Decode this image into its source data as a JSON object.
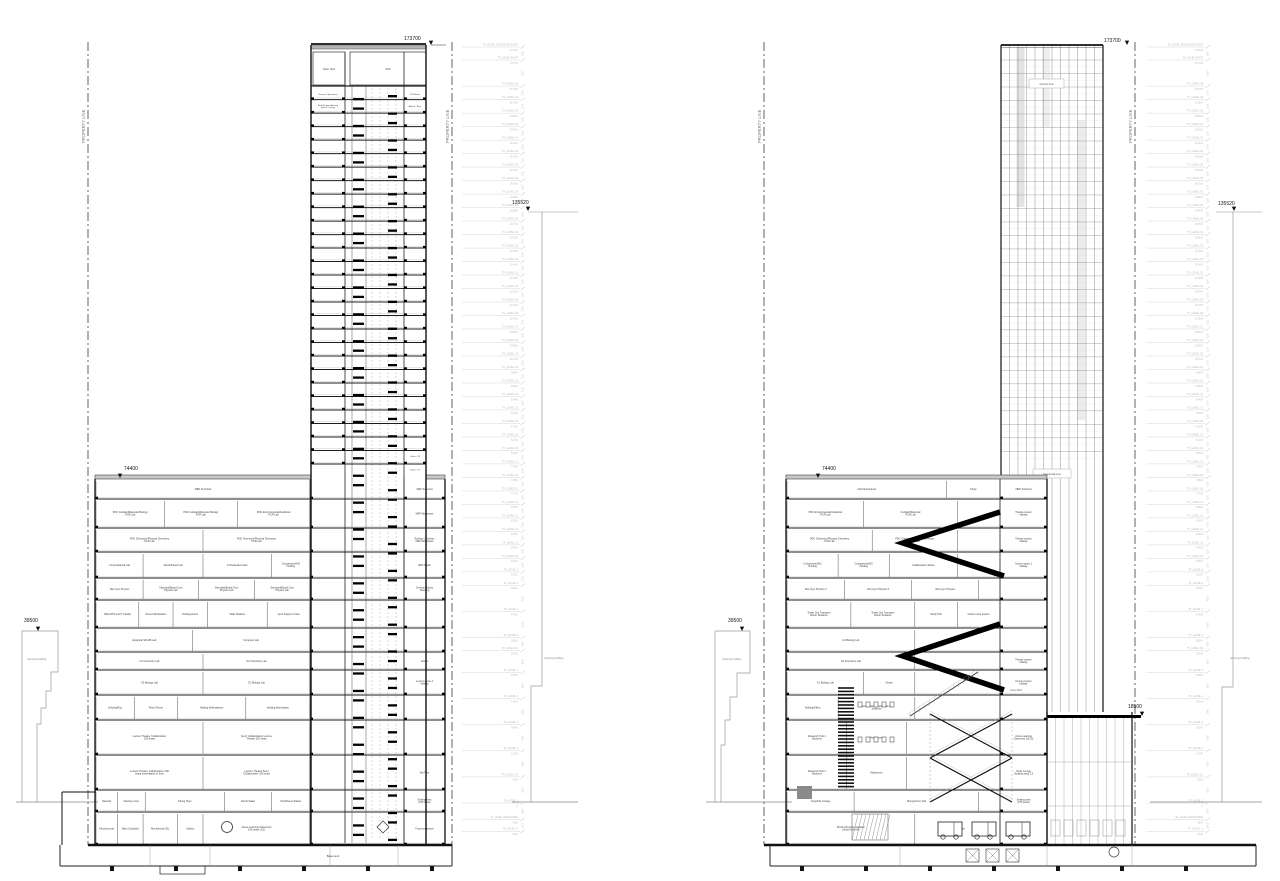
{
  "annotations": {
    "property_line": "PROPERTY LINE",
    "existing_building": "Existing building",
    "basement": "Basement"
  },
  "markers": {
    "tower_top": "173700",
    "mid_tower": "135520",
    "podium_top": "74400",
    "existing_left": "39500",
    "annex_roof": "18500"
  },
  "levels": [
    [
      "TF_LEVEL TECHNICAL ROOF",
      "173700",
      173700
    ],
    [
      "TF_LEVEL ROOF",
      "170700",
      170700
    ],
    [
      "TF_LEVEL 45",
      "164700",
      164700
    ],
    [
      "TF_LEVEL 44",
      "161600",
      161600
    ],
    [
      "TF_LEVEL 43",
      "158500",
      158500
    ],
    [
      "TF_LEVEL 42",
      "155400",
      155400
    ],
    [
      "TF_LEVEL 41",
      "152300",
      152300
    ],
    [
      "TF_LEVEL 40",
      "149200",
      149200
    ],
    [
      "TF_LEVEL 39",
      "146100",
      146100
    ],
    [
      "TF_LEVEL 38",
      "143000",
      143000
    ],
    [
      "TF_LEVEL 37",
      "139900",
      139900
    ],
    [
      "TF_LEVEL 36",
      "136800",
      136800
    ],
    [
      "TF_LEVEL 35",
      "133700",
      133700
    ],
    [
      "TF_LEVEL 34",
      "130600",
      130600
    ],
    [
      "TF_LEVEL 33",
      "127500",
      127500
    ],
    [
      "TF_LEVEL 32",
      "124400",
      124400
    ],
    [
      "TF_LEVEL 31",
      "121300",
      121300
    ],
    [
      "TF_LEVEL 30",
      "118200",
      118200
    ],
    [
      "TF_LEVEL 29",
      "115100",
      115100
    ],
    [
      "TF_LEVEL 28",
      "112000",
      112000
    ],
    [
      "TF_LEVEL 27",
      "108900",
      108900
    ],
    [
      "TF_LEVEL 26",
      "105800",
      105800
    ],
    [
      "TF_LEVEL 25",
      "102700",
      102700
    ],
    [
      "TF_LEVEL 24",
      "99600",
      99600
    ],
    [
      "TF_LEVEL 23",
      "96500",
      96500
    ],
    [
      "TF_LEVEL 22",
      "93400",
      93400
    ],
    [
      "TF_LEVEL 21",
      "90300",
      90300
    ],
    [
      "TF_LEVEL 20",
      "87200",
      87200
    ],
    [
      "TF_LEVEL 19",
      "84100",
      84100
    ],
    [
      "TF_LEVEL 18",
      "81000",
      81000
    ],
    [
      "TF_LEVEL 17",
      "77900",
      77900
    ],
    [
      "TF_LEVEL 16",
      "74800",
      74800
    ],
    [
      "TF_LEVEL 15",
      "71700",
      71700
    ],
    [
      "TF_LEVEL 14",
      "68600",
      68600
    ],
    [
      "TF_LEVEL 13",
      "65500",
      65500
    ],
    [
      "TF_LEVEL 12",
      "62400",
      62400
    ],
    [
      "TF_LEVEL 11",
      "59300",
      59300
    ],
    [
      "TF_LEVEL 10",
      "56200",
      56200
    ],
    [
      "TF_LEVEL 9",
      "53100",
      53100
    ],
    [
      "TF_LEVEL 8",
      "50000",
      50000
    ],
    [
      "TF_LEVEL 7",
      "44000",
      44000
    ],
    [
      "TF_LEVEL 6",
      "38000",
      38000
    ],
    [
      "TF_LEVEL 5A",
      "35000",
      35000
    ],
    [
      "TF_LEVEL 5",
      "30000",
      30000
    ],
    [
      "TF_LEVEL 4",
      "24000",
      24000
    ],
    [
      "TF_LEVEL 3",
      "18000",
      18000
    ],
    [
      "TF_LEVEL 2",
      "12000",
      12000
    ],
    [
      "TF_LEVEL 1A",
      "6000",
      6000
    ],
    [
      "TF_LEVEL 1",
      "0",
      0
    ],
    [
      "TF_LEVEL MEZZANINE",
      "-3800",
      -3800
    ],
    [
      "TF_LEVEL -1",
      "-6500",
      -6500
    ]
  ],
  "section1": {
    "tower": {
      "mech_rooms": [
        "Open Tech",
        "Tech"
      ],
      "upper_floors": [
        {
          "left": "Science Operations",
          "right": "RJI Room"
        },
        {
          "left": "Multi Purpose Amenity\nSpace / Lounge",
          "right": "Admin Office"
        }
      ],
      "suites": [
        "Suite n 76",
        "Suite n 77"
      ]
    },
    "podium_floors": [
      {
        "h": 20,
        "rooms": [
          [
            "MEP Technical",
            1
          ]
        ],
        "right": "MEP Technical"
      },
      {
        "h": 29,
        "rooms": [
          [
            "PDC Cellular/Molecular Biology\nPCR Lab",
            0.32
          ],
          [
            "PDC Cellular/Molecular Biology\nPCR Lab",
            0.34
          ],
          [
            "PDC Environmental/Analytical\nPCR Lab",
            0.34
          ]
        ],
        "right": "MEP Workspace"
      },
      {
        "h": 24,
        "rooms": [
          [
            "PDC Chemistry/Physical Chemistry\nPCR Lab",
            0.5
          ],
          [
            "PDC Chemistry/Physical Chemistry\nPCR Lab",
            0.5
          ]
        ],
        "right": "Rooftop Chemistry\nMEP Workspace"
      },
      {
        "h": 26,
        "rooms": [
          [
            "Computational Lab",
            0.22
          ],
          [
            "Stand Based Lab",
            0.28
          ],
          [
            "PI Dedicated Labs",
            0.32
          ],
          [
            "Compressed/N2\nHolding",
            0.18
          ]
        ],
        "right": "MEP Studio"
      },
      {
        "h": 22,
        "rooms": [
          [
            "Wet Gym Physics",
            0.22
          ],
          [
            "Standard/Board Gym\nPhysics Lab",
            0.26
          ],
          [
            "Standard/Board Gym\nPhysics Lab",
            0.26
          ],
          [
            "Standard/Board Gym\nPhysics Lab",
            0.26
          ]
        ],
        "right": "General Physics\nTeaching"
      },
      {
        "h": 28,
        "rooms": [
          [
            "Office/IPS and IT Facility",
            0.2
          ],
          [
            "Server Workstation",
            0.16
          ],
          [
            "Holding Room",
            0.16
          ],
          [
            "Skills Stations",
            0.28
          ],
          [
            "Input Support Union",
            0.2
          ]
        ],
        "right": ""
      },
      {
        "h": 24,
        "rooms": [
          [
            "Analytical SR-MS Lab",
            0.45
          ],
          [
            "Computer Lab",
            0.55
          ]
        ],
        "right": ""
      },
      {
        "h": 18,
        "rooms": [
          [
            "G3 Chemistry Lab",
            0.5
          ],
          [
            "G2 Chemistry Lab",
            0.5
          ]
        ],
        "right": "Atrium"
      },
      {
        "h": 25,
        "rooms": [
          [
            "G3 Biology Lab",
            0.5
          ],
          [
            "G1 Biology Lab",
            0.5
          ]
        ],
        "right": "Lecture above 1\nhallway"
      },
      {
        "h": 25,
        "rooms": [
          [
            "Holding/Disc",
            0.18
          ],
          [
            "Prep's Room",
            0.2
          ],
          [
            "Holding Workstations",
            0.32
          ],
          [
            "Holding Workstation",
            0.3
          ]
        ],
        "right": ""
      },
      {
        "h": 35,
        "rooms": [
          [
            "Lecture Theatre 'Collaborative'\n200 seats",
            0.5
          ],
          [
            "Semi 'Collaborative' Lecture\nTheatre 150 seats",
            0.5
          ]
        ],
        "right": ""
      },
      {
        "h": 35,
        "rooms": [
          [
            "Lecture Theatre 'Collaborative' 250\nseats presentation in front",
            0.5
          ],
          [
            "Lecture Theatre Semi\n'Collaborative' 150 seats",
            0.5
          ]
        ],
        "right": "My Party"
      },
      {
        "h": 22,
        "rooms": [
          [
            "Network",
            0.1
          ],
          [
            "Meeting room",
            0.13
          ],
          [
            "Dining Hyve",
            0.37
          ],
          [
            "Deli & Salad",
            0.22
          ],
          [
            "Chef/Demo Station",
            0.18
          ]
        ],
        "right": "Seating Area\n(250 seats)"
      },
      {
        "h": 33,
        "rooms": [
          [
            "Electrical cart",
            0.1
          ],
          [
            "Main Custodial",
            0.12
          ],
          [
            "Mechanical (S1)",
            0.16
          ],
          [
            "Gallery",
            0.12
          ],
          [
            "Active Learning Classroom\n160 seats (1,5)",
            0.5
          ]
        ],
        "right": "Food preparation"
      }
    ]
  },
  "section2": {
    "tower_labels": {
      "upper": "Amenity level",
      "lower": "Residential level"
    },
    "green_roof": "Green Roof",
    "podium_floors": [
      {
        "h": 20,
        "rooms": [
          [
            "Mechanical level",
            0.75
          ],
          [
            "Study",
            0.25
          ]
        ],
        "right": "MEP Technical"
      },
      {
        "h": 29,
        "bw": 0.8,
        "rooms": [
          [
            "PDC Environmental/Analytical\nPCR Lab",
            0.45
          ],
          [
            "Cellular/Molecular\nPCR Lab",
            0.55
          ]
        ],
        "right": "Theatre system\nhallway"
      },
      {
        "h": 24,
        "bw": 0.8,
        "rooms": [
          [
            "PDC Chemistry/Physical Chemistry\nPCR Lab",
            0.5
          ],
          [
            "PDC Chemistry/Physical Chemistry\nPCR Lab",
            0.5
          ]
        ],
        "right": "Theatre system\nhallway"
      },
      {
        "h": 26,
        "bw": 0.8,
        "rooms": [
          [
            "Compressed/N2\nHolding",
            0.3
          ],
          [
            "Compressed/N2\nHolding",
            0.3
          ],
          [
            "Collaboration Space",
            0.4
          ]
        ],
        "right": "Comm's place 1\nhallway"
      },
      {
        "h": 22,
        "bw": 0.9,
        "rooms": [
          [
            "Wet Gym Physics 2",
            0.3
          ],
          [
            "Wet Gym Physics 3",
            0.35
          ],
          [
            "Wet Gym Physics",
            0.35
          ]
        ],
        "right": ""
      },
      {
        "h": 28,
        "rooms": [
          [
            "Smart City Transport\nRoom Students",
            0.3
          ],
          [
            "Smart City Transport\nRoom Students",
            0.3
          ],
          [
            "Study Hub",
            0.2
          ],
          [
            "Indoor cycle lockers",
            0.2
          ]
        ],
        "right": ""
      },
      {
        "h": 24,
        "bw": 0.6,
        "rooms": [
          [
            "G3 Biology Lab",
            1
          ]
        ],
        "right": ""
      },
      {
        "h": 18,
        "bw": 0.6,
        "rooms": [
          [
            "G2 Chemistry Lab",
            1
          ]
        ],
        "right": "Theatre system\nhallway"
      },
      {
        "h": 25,
        "bw": 0.6,
        "rooms": [
          [
            "G1 Biology Lab",
            0.6
          ],
          [
            "Atrium",
            0.4
          ]
        ],
        "right": "Cinema system\nhallway"
      },
      {
        "h": 25,
        "bw": 0.6,
        "rooms": [
          [
            "Holding/Office",
            0.4
          ],
          [
            "Transportation Studio/Fab Lab\nStudents",
            0.6
          ]
        ],
        "right": ""
      },
      {
        "h": 35,
        "bw": 0.56,
        "rooms": [
          [
            "Research Hub 1\nStudents",
            0.5
          ],
          [
            "Washroom",
            0.5
          ]
        ],
        "right": "Active Learning\nClassroom (2x2,5)"
      },
      {
        "h": 35,
        "bw": 0.56,
        "rooms": [
          [
            "Research Hub 2\nStudents",
            0.5
          ],
          [
            "Washroom",
            0.5
          ]
        ],
        "right": "Study Lounge\n(Seating area) 2,5"
      },
      {
        "h": 22,
        "bw": 0.9,
        "rooms": [
          [
            "Copy/File storage",
            0.35
          ],
          [
            "Dining Room hall",
            0.65
          ]
        ],
        "right": "Seating area\n(275 seats)"
      },
      {
        "h": 33,
        "rooms": [
          [
            "Kitchen/Food preparation\nbelow level hall",
            0.6
          ],
          [
            "Loading dock",
            0.4
          ]
        ],
        "right": ""
      }
    ]
  }
}
